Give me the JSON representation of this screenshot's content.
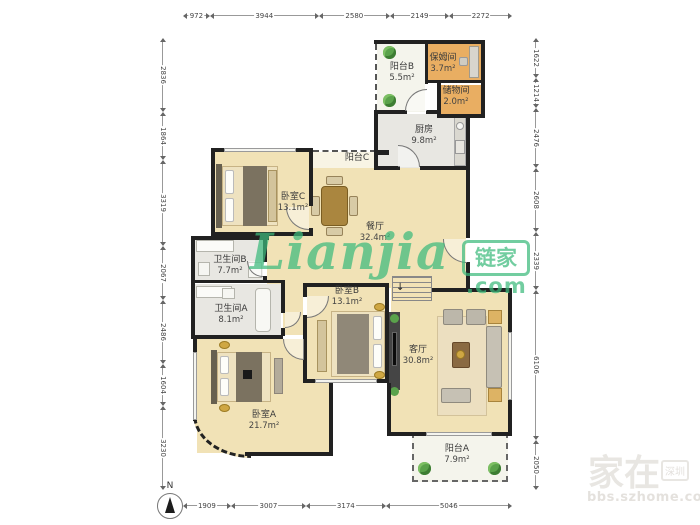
{
  "compass": {
    "north_label": "N"
  },
  "watermark_center": {
    "script": "Lianjia",
    "brand": "链家",
    "suffix": ".com"
  },
  "watermark_corner": {
    "big": "家在",
    "tag": "深圳",
    "url": "bbs.szhome.com"
  },
  "rulers": {
    "top": [
      "972",
      "3944",
      "2580",
      "2149",
      "2272"
    ],
    "bottom": [
      "1909",
      "3007",
      "3174",
      "5046"
    ],
    "left": [
      "2836",
      "1864",
      "3319",
      "2067",
      "2486",
      "1604",
      "3230"
    ],
    "right": [
      "1622",
      "1214",
      "2476",
      "2608",
      "2339",
      "6106",
      "2050"
    ]
  },
  "rooms": [
    {
      "id": "balcony-b",
      "name": "阳台B",
      "area": "5.5m²"
    },
    {
      "id": "nanny-room",
      "name": "保姆间",
      "area": "3.7m²"
    },
    {
      "id": "storage",
      "name": "储物间",
      "area": "2.0m²"
    },
    {
      "id": "kitchen",
      "name": "厨房",
      "area": "9.8m²"
    },
    {
      "id": "balcony-c",
      "name": "阳台C",
      "area": ""
    },
    {
      "id": "bedroom-c",
      "name": "卧室C",
      "area": "13.1m²"
    },
    {
      "id": "dining",
      "name": "餐厅",
      "area": "32.4m²"
    },
    {
      "id": "bath-b",
      "name": "卫生间B",
      "area": "7.7m²"
    },
    {
      "id": "bath-a",
      "name": "卫生间A",
      "area": "8.1m²"
    },
    {
      "id": "bedroom-b",
      "name": "卧室B",
      "area": "13.1m²"
    },
    {
      "id": "living",
      "name": "客厅",
      "area": "30.8m²"
    },
    {
      "id": "bedroom-a",
      "name": "卧室A",
      "area": "21.7m²"
    },
    {
      "id": "balcony-a",
      "name": "阳台A",
      "area": "7.9m²"
    }
  ],
  "colors": {
    "beige": "#f1e2b6",
    "grayrm": "#e8e7e2",
    "orange": "#e9ae62",
    "balcony": "#f4f4ec",
    "balcony2": "#f8f4e4",
    "wall": "#212121",
    "green": "#3cba7c",
    "plant": "#5aa24b"
  }
}
